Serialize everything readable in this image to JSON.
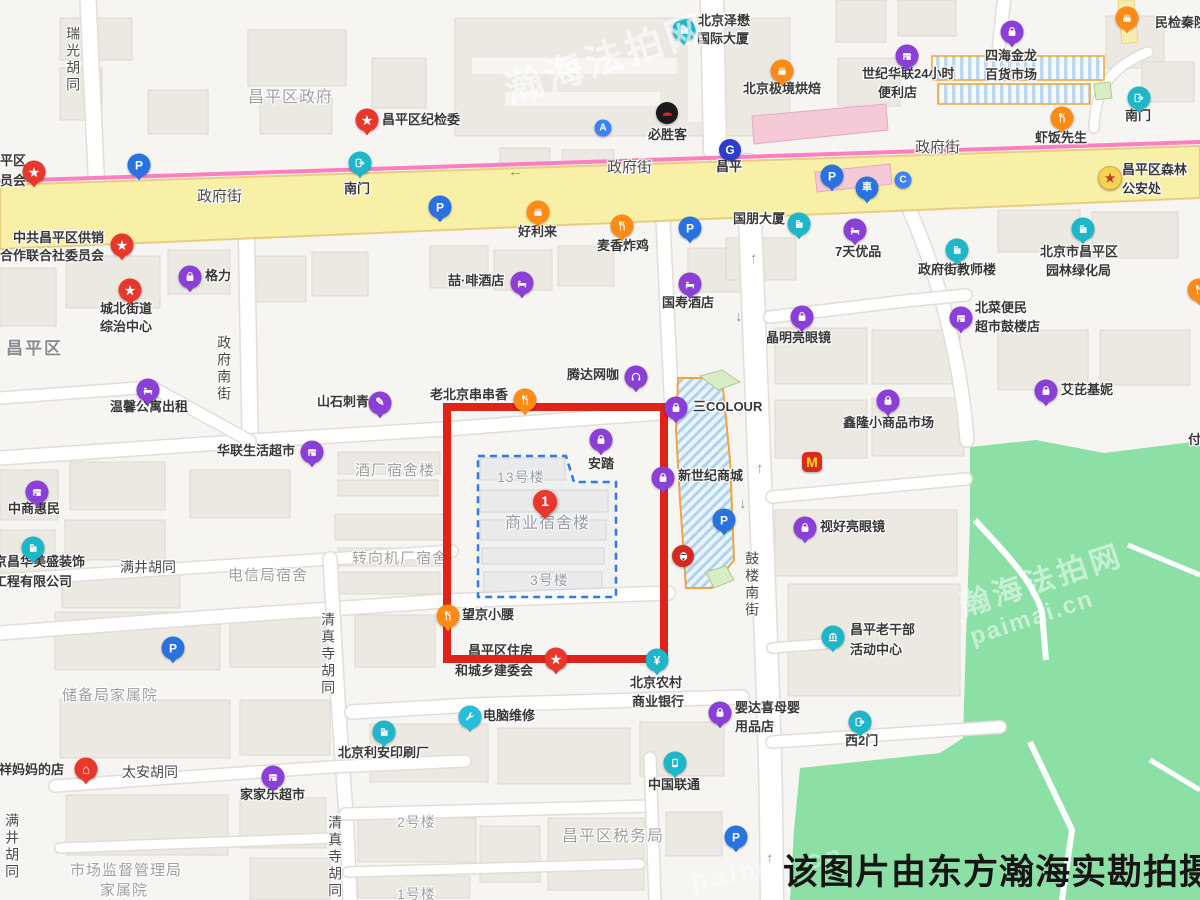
{
  "caption": "该图片由东方瀚海实勘拍摄",
  "watermark": {
    "site": "瀚海法拍网",
    "domain": "paimai.cn"
  },
  "highlight": {
    "number": "1",
    "area_name": "商业宿舍楼"
  },
  "palette": {
    "purple": "#8B3FD6",
    "teal": "#1EB6C9",
    "blue": "#2A72E0",
    "blue2": "#3B82F6",
    "red": "#E8382C",
    "orange": "#FF8A15",
    "cyan": "#25BEDC",
    "black": "#1A1A1A",
    "kfc": "#D5281E",
    "mcd": "#DB2B1F",
    "metro": "#2B3ECE",
    "gold": "#F7D354",
    "highlight_box": "#E02318",
    "parcel_dash": "#2E7BE5",
    "road_main": "#F9F0A7",
    "rail_line": "#FF7EC0",
    "park_green": "#8CE0A6"
  },
  "map": {
    "labels": [
      {
        "t": "昌平区纪检委",
        "x": 382,
        "y": 113
      },
      {
        "t": "中共昌平区供销",
        "x": 13,
        "y": 231
      },
      {
        "t": "合作联合社委员会",
        "x": 0,
        "y": 249
      },
      {
        "t": "城北街道",
        "x": 100,
        "y": 302
      },
      {
        "t": "综治中心",
        "x": 100,
        "y": 320
      },
      {
        "t": "格力",
        "x": 205,
        "y": 269
      },
      {
        "t": "温馨公寓出租",
        "x": 110,
        "y": 400
      },
      {
        "t": "山石刺青",
        "x": 317,
        "y": 395
      },
      {
        "t": "华联生活超市",
        "x": 217,
        "y": 444
      },
      {
        "t": "中商惠民",
        "x": 8,
        "y": 502
      },
      {
        "t": "京昌华美盛装饰",
        "x": -6,
        "y": 555
      },
      {
        "t": "工程有限公司",
        "x": -6,
        "y": 575
      },
      {
        "t": "满井胡同",
        "x": 120,
        "y": 559,
        "k": "road"
      },
      {
        "t": "电信局宿舍",
        "x": 228,
        "y": 567,
        "k": "area",
        "s": 15
      },
      {
        "t": "转向机厂宿舍",
        "x": 352,
        "y": 550,
        "k": "area",
        "s": 15
      },
      {
        "t": "酒厂宿舍楼",
        "x": 355,
        "y": 462,
        "k": "area",
        "s": 15
      },
      {
        "t": "13号楼",
        "x": 497,
        "y": 469,
        "k": "area"
      },
      {
        "t": "商业宿舍楼",
        "x": 505,
        "y": 515,
        "k": "area",
        "s": 16
      },
      {
        "t": "3号楼",
        "x": 530,
        "y": 572,
        "k": "area"
      },
      {
        "t": "安踏",
        "x": 588,
        "y": 457
      },
      {
        "t": "三COLOUR",
        "x": 693,
        "y": 400
      },
      {
        "t": "新世纪商城",
        "x": 678,
        "y": 469
      },
      {
        "t": "腾达网咖",
        "x": 567,
        "y": 368
      },
      {
        "t": "老北京串串香",
        "x": 430,
        "y": 388
      },
      {
        "t": "望京小腰",
        "x": 462,
        "y": 608
      },
      {
        "t": "昌平区住房",
        "x": 468,
        "y": 644
      },
      {
        "t": "和城乡建委会",
        "x": 455,
        "y": 664
      },
      {
        "t": "北京农村",
        "x": 630,
        "y": 676
      },
      {
        "t": "商业银行",
        "x": 632,
        "y": 695
      },
      {
        "t": "电脑维修",
        "x": 483,
        "y": 709
      },
      {
        "t": "北京利安印刷厂",
        "x": 338,
        "y": 746
      },
      {
        "t": "中国联通",
        "x": 648,
        "y": 778
      },
      {
        "t": "昌平区税务局",
        "x": 562,
        "y": 828,
        "k": "area",
        "s": 16
      },
      {
        "t": "2号楼",
        "x": 397,
        "y": 814,
        "k": "area"
      },
      {
        "t": "1号楼",
        "x": 397,
        "y": 886,
        "k": "area"
      },
      {
        "t": "储备局家属院",
        "x": 62,
        "y": 687,
        "k": "area",
        "s": 15
      },
      {
        "t": "市场监督管理局",
        "x": 70,
        "y": 862,
        "k": "area",
        "s": 15
      },
      {
        "t": "家属院",
        "x": 100,
        "y": 882,
        "k": "area",
        "s": 15
      },
      {
        "t": "太安胡同",
        "x": 122,
        "y": 764,
        "k": "road"
      },
      {
        "t": "吉祥妈妈的店",
        "x": -14,
        "y": 763
      },
      {
        "t": "家家乐超市",
        "x": 240,
        "y": 788
      },
      {
        "t": "清真寺胡同",
        "x": 320,
        "y": 612,
        "k": "road",
        "v": 1
      },
      {
        "t": "清真寺胡同",
        "x": 327,
        "y": 815,
        "k": "road",
        "v": 1
      },
      {
        "t": "满井胡同",
        "x": 4,
        "y": 813,
        "k": "road",
        "v": 1
      },
      {
        "t": "政府南街",
        "x": 216,
        "y": 335,
        "k": "road",
        "v": 1
      },
      {
        "t": "鼓楼南街",
        "x": 744,
        "y": 551,
        "k": "road",
        "v": 1
      },
      {
        "t": "瑞光胡同",
        "x": 65,
        "y": 26,
        "k": "road",
        "v": 1
      },
      {
        "t": "政府街",
        "x": 197,
        "y": 188,
        "k": "road",
        "s": 15
      },
      {
        "t": "政府街",
        "x": 607,
        "y": 159,
        "k": "road",
        "s": 15
      },
      {
        "t": "政府街",
        "x": 915,
        "y": 139,
        "k": "road",
        "s": 15
      },
      {
        "t": "昌平区政府",
        "x": 248,
        "y": 89,
        "k": "area",
        "s": 16
      },
      {
        "t": "昌平区",
        "x": 6,
        "y": 339,
        "k": "dist"
      },
      {
        "t": "昌平",
        "x": 716,
        "y": 160
      },
      {
        "t": "南门",
        "x": 344,
        "y": 182
      },
      {
        "t": "南门",
        "x": 1125,
        "y": 109
      },
      {
        "t": "必胜客",
        "x": 648,
        "y": 128
      },
      {
        "t": "北京泽懋",
        "x": 698,
        "y": 14
      },
      {
        "t": "国际大厦",
        "x": 697,
        "y": 32
      },
      {
        "t": "北京极境烘焙",
        "x": 743,
        "y": 82
      },
      {
        "t": "好利来",
        "x": 518,
        "y": 225
      },
      {
        "t": "麦香炸鸡",
        "x": 597,
        "y": 239
      },
      {
        "t": "喆·啡酒店",
        "x": 448,
        "y": 274
      },
      {
        "t": "国寿酒店",
        "x": 662,
        "y": 296
      },
      {
        "t": "7天优品",
        "x": 835,
        "y": 245
      },
      {
        "t": "国朋大厦",
        "x": 733,
        "y": 212
      },
      {
        "t": "世纪华联24小时",
        "x": 862,
        "y": 67
      },
      {
        "t": "便利店",
        "x": 878,
        "y": 86
      },
      {
        "t": "四海金龙",
        "x": 985,
        "y": 49
      },
      {
        "t": "百货市场",
        "x": 985,
        "y": 68
      },
      {
        "t": "虾饭先生",
        "x": 1035,
        "y": 131
      },
      {
        "t": "昌平区森林",
        "x": 1122,
        "y": 163
      },
      {
        "t": "公安处",
        "x": 1122,
        "y": 182
      },
      {
        "t": "政府街教师楼",
        "x": 918,
        "y": 263
      },
      {
        "t": "北京市昌平区",
        "x": 1040,
        "y": 245
      },
      {
        "t": "园林绿化局",
        "x": 1046,
        "y": 264
      },
      {
        "t": "北菜便民",
        "x": 975,
        "y": 301
      },
      {
        "t": "超市鼓楼店",
        "x": 975,
        "y": 320
      },
      {
        "t": "晶明亮眼镜",
        "x": 766,
        "y": 331
      },
      {
        "t": "鑫隆小商品市场",
        "x": 843,
        "y": 416
      },
      {
        "t": "艾芘基妮",
        "x": 1061,
        "y": 383
      },
      {
        "t": "视好亮眼镜",
        "x": 820,
        "y": 520
      },
      {
        "t": "昌平老干部",
        "x": 850,
        "y": 623
      },
      {
        "t": "活动中心",
        "x": 850,
        "y": 643
      },
      {
        "t": "婴达喜母婴",
        "x": 735,
        "y": 701
      },
      {
        "t": "用品店",
        "x": 735,
        "y": 720
      },
      {
        "t": "西2门",
        "x": 845,
        "y": 734
      },
      {
        "t": "付",
        "x": 1188,
        "y": 433
      },
      {
        "t": "民检秦院",
        "x": 1155,
        "y": 16
      },
      {
        "t": "平区",
        "x": 0,
        "y": 154
      },
      {
        "t": "员会",
        "x": 0,
        "y": 174
      },
      {
        "t": "←",
        "x": 508,
        "y": 163,
        "k": "arr"
      },
      {
        "t": "↑",
        "x": 750,
        "y": 250,
        "k": "arr"
      },
      {
        "t": "↓",
        "x": 735,
        "y": 308,
        "k": "arr"
      },
      {
        "t": "↑",
        "x": 756,
        "y": 460,
        "k": "arr"
      },
      {
        "t": "↓",
        "x": 739,
        "y": 495,
        "k": "arr"
      },
      {
        "t": "↑",
        "x": 766,
        "y": 850,
        "k": "arr"
      }
    ],
    "markers": [
      {
        "n": "poi-jijianwei-pin",
        "g": "star",
        "c": "red",
        "x": 367,
        "y": 120
      },
      {
        "n": "poi-gongxiaoshe-pin",
        "g": "star",
        "c": "red",
        "x": 122,
        "y": 245
      },
      {
        "n": "poi-chengbei-zongzhi-pin",
        "g": "star",
        "c": "red",
        "x": 130,
        "y": 290
      },
      {
        "n": "poi-zhufang-jianwei-pin",
        "g": "star",
        "c": "red",
        "x": 556,
        "y": 659
      },
      {
        "n": "poi-gov-edge-pin",
        "g": "star",
        "c": "red",
        "x": 34,
        "y": 172
      },
      {
        "n": "poi-jixiang-mama-pin",
        "g": "house",
        "c": "red",
        "x": 86,
        "y": 769
      },
      {
        "n": "poi-geli-pin",
        "g": "bag",
        "c": "purple",
        "x": 190,
        "y": 277
      },
      {
        "n": "poi-anta-pin",
        "g": "bag",
        "c": "purple",
        "x": 601,
        "y": 440
      },
      {
        "n": "poi-3colour-pin",
        "g": "bag",
        "c": "purple",
        "x": 676,
        "y": 408
      },
      {
        "n": "poi-xinshiji-shangcheng-pin",
        "g": "bag",
        "c": "purple",
        "x": 663,
        "y": 478
      },
      {
        "n": "poi-jingmingliang-pin",
        "g": "bag",
        "c": "purple",
        "x": 802,
        "y": 317
      },
      {
        "n": "poi-xinlong-shichang-pin",
        "g": "bag",
        "c": "purple",
        "x": 888,
        "y": 401
      },
      {
        "n": "poi-aipijini-pin",
        "g": "bag",
        "c": "purple",
        "x": 1046,
        "y": 391
      },
      {
        "n": "poi-shihaoliang-pin",
        "g": "bag",
        "c": "purple",
        "x": 805,
        "y": 528
      },
      {
        "n": "poi-yingdaxi-pin",
        "g": "bag",
        "c": "purple",
        "x": 720,
        "y": 713
      },
      {
        "n": "poi-sihaijinlong-pin",
        "g": "bag",
        "c": "purple",
        "x": 1012,
        "y": 32
      },
      {
        "n": "poi-shanshi-ciqing-pin",
        "g": "pen",
        "c": "purple",
        "x": 380,
        "y": 403
      },
      {
        "n": "poi-tengda-wangka-pin",
        "g": "headset",
        "c": "purple",
        "x": 636,
        "y": 377
      },
      {
        "n": "poi-shijihualian-pin",
        "g": "shop",
        "c": "purple",
        "x": 907,
        "y": 56
      },
      {
        "n": "poi-zhongshang-huimin-pin",
        "g": "shop",
        "c": "purple",
        "x": 37,
        "y": 492
      },
      {
        "n": "poi-hualian-chaoshi-pin",
        "g": "shop",
        "c": "purple",
        "x": 312,
        "y": 452
      },
      {
        "n": "poi-jiajiale-pin",
        "g": "shop",
        "c": "purple",
        "x": 273,
        "y": 777
      },
      {
        "n": "poi-beicai-bianmin-pin",
        "g": "shop",
        "c": "purple",
        "x": 961,
        "y": 318
      },
      {
        "n": "poi-wenxin-gongyu-pin",
        "g": "bed",
        "c": "purple",
        "x": 148,
        "y": 390
      },
      {
        "n": "poi-zhefei-hotel-pin",
        "g": "bed",
        "c": "purple",
        "x": 522,
        "y": 283
      },
      {
        "n": "poi-7tian-pin",
        "g": "bed",
        "c": "purple",
        "x": 855,
        "y": 230
      },
      {
        "n": "poi-guoshou-hotel-pin",
        "g": "bed",
        "c": "purple",
        "x": 690,
        "y": 284
      },
      {
        "n": "poi-jingchang-zhuangshi-pin",
        "g": "building",
        "c": "teal",
        "x": 33,
        "y": 548
      },
      {
        "n": "poi-lian-yinshua-pin",
        "g": "building",
        "c": "teal",
        "x": 384,
        "y": 732
      },
      {
        "n": "poi-jiaoshilou-pin",
        "g": "building",
        "c": "teal",
        "x": 957,
        "y": 250
      },
      {
        "n": "poi-yuanlin-lvhua-pin",
        "g": "building",
        "c": "teal",
        "x": 1083,
        "y": 229
      },
      {
        "n": "poi-zemao-daxia-pin",
        "g": "building",
        "c": "teal",
        "x": 684,
        "y": 30
      },
      {
        "n": "poi-guopeng-daxia-pin",
        "g": "building",
        "c": "teal",
        "x": 799,
        "y": 224
      },
      {
        "n": "poi-laoganbu-zhongxin-pin",
        "g": "bank",
        "c": "teal",
        "x": 833,
        "y": 637
      },
      {
        "n": "poi-nongshang-bank-pin",
        "g": "yen",
        "c": "teal",
        "x": 657,
        "y": 660
      },
      {
        "n": "poi-liantong-pin",
        "g": "phone",
        "c": "teal",
        "x": 675,
        "y": 763
      },
      {
        "n": "poi-nanmen-west-pin",
        "g": "exit",
        "c": "teal",
        "x": 360,
        "y": 163
      },
      {
        "n": "poi-nanmen-ne-pin",
        "g": "exit",
        "c": "teal",
        "x": 1139,
        "y": 98
      },
      {
        "n": "poi-xi2men-pin",
        "g": "exit",
        "c": "teal",
        "x": 860,
        "y": 722
      },
      {
        "n": "poi-parking-1",
        "g": "P",
        "c": "blue",
        "x": 139,
        "y": 165
      },
      {
        "n": "poi-parking-2",
        "g": "P",
        "c": "blue",
        "x": 440,
        "y": 207
      },
      {
        "n": "poi-parking-3",
        "g": "P",
        "c": "blue",
        "x": 690,
        "y": 228
      },
      {
        "n": "poi-parking-4",
        "g": "P",
        "c": "blue",
        "x": 832,
        "y": 176
      },
      {
        "n": "poi-parking-5",
        "g": "P",
        "c": "blue",
        "x": 173,
        "y": 648
      },
      {
        "n": "poi-parking-6",
        "g": "P",
        "c": "blue",
        "x": 724,
        "y": 520
      },
      {
        "n": "poi-parking-7",
        "g": "P",
        "c": "blue",
        "x": 736,
        "y": 837
      },
      {
        "n": "poi-parking-garage",
        "g": "car",
        "c": "blue",
        "x": 867,
        "y": 188
      },
      {
        "n": "poi-entrance-a",
        "t": "dot",
        "g": "A",
        "c": "blue2",
        "x": 603,
        "y": 128
      },
      {
        "n": "poi-entrance-c",
        "t": "dot",
        "g": "C",
        "c": "blue2",
        "x": 903,
        "y": 180
      },
      {
        "n": "poi-metro-changping",
        "t": "dot2",
        "g": "G",
        "c": "metro",
        "x": 730,
        "y": 150
      },
      {
        "n": "poi-holiland-pin",
        "g": "cake",
        "c": "orange",
        "x": 538,
        "y": 212
      },
      {
        "n": "poi-jijing-hongbei-pin",
        "g": "cake",
        "c": "orange",
        "x": 782,
        "y": 71
      },
      {
        "n": "poi-maixiang-zhaji-pin",
        "g": "fork",
        "c": "orange",
        "x": 622,
        "y": 226
      },
      {
        "n": "poi-xiafan-xiansheng-pin",
        "g": "fork",
        "c": "orange",
        "x": 1062,
        "y": 118
      },
      {
        "n": "poi-chuanchuanxiang-pin",
        "g": "fork",
        "c": "orange",
        "x": 525,
        "y": 400
      },
      {
        "n": "poi-wangjing-xiaoyao-pin",
        "g": "fork",
        "c": "orange",
        "x": 448,
        "y": 616
      },
      {
        "n": "poi-food-edge-east",
        "g": "fork",
        "c": "orange",
        "x": 1199,
        "y": 290
      },
      {
        "n": "poi-food-edge-ne",
        "g": "cake",
        "c": "orange",
        "x": 1127,
        "y": 18
      },
      {
        "n": "poi-diannao-weixiu-pin",
        "g": "wrench",
        "c": "cyan",
        "x": 470,
        "y": 717
      },
      {
        "n": "poi-pizzahut",
        "t": "dot2",
        "g": "hat",
        "c": "black",
        "x": 667,
        "y": 113
      },
      {
        "n": "poi-kfc",
        "t": "dot2",
        "g": "face",
        "c": "kfc",
        "x": 683,
        "y": 556
      },
      {
        "n": "poi-mcdonalds",
        "t": "sq",
        "g": "M",
        "c": "mcd",
        "x": 812,
        "y": 462
      },
      {
        "n": "poi-senlin-gongan-badge",
        "t": "badge",
        "g": "star",
        "c": "gold",
        "x": 1110,
        "y": 178
      }
    ]
  }
}
